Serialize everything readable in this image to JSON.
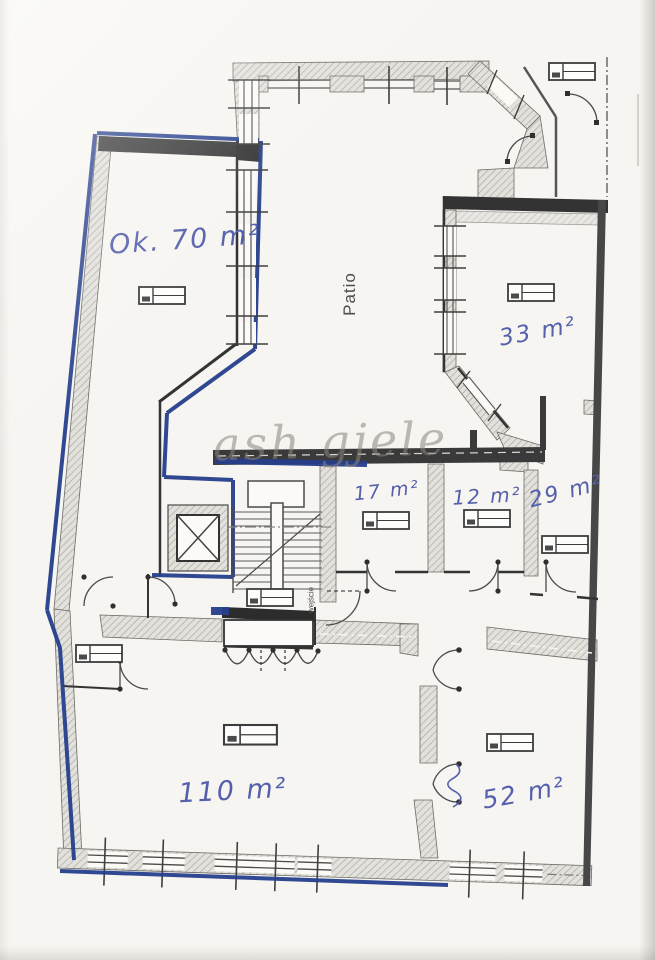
{
  "document": {
    "kind": "scanned architectural floor plan",
    "watermark_text": "ash gjele"
  },
  "labels": {
    "patio": "Patio",
    "entrance": "wejście"
  },
  "rooms": [
    {
      "id": "room-ok-70",
      "area_label": "Ok. 70 m²"
    },
    {
      "id": "room-33",
      "area_label": "33 m²"
    },
    {
      "id": "room-17",
      "area_label": "17 m²"
    },
    {
      "id": "room-12",
      "area_label": "12 m²"
    },
    {
      "id": "room-29",
      "area_label": "29 m²"
    },
    {
      "id": "room-110",
      "area_label": "110 m²"
    },
    {
      "id": "room-52",
      "area_label": "52 m²"
    }
  ],
  "icons": {
    "radiator": "radiator-icon",
    "elevator": "elevator-shaft-icon",
    "staircase": "staircase-icon",
    "door": "door-swing-icon",
    "window": "window-symbol"
  },
  "colors": {
    "paper": "#f7f5f1",
    "handwriting_ink": "#5560ac",
    "unit_highlight": "#263f8c",
    "wall_dark": "#3a3a3a",
    "watermark": "#8a847a"
  }
}
